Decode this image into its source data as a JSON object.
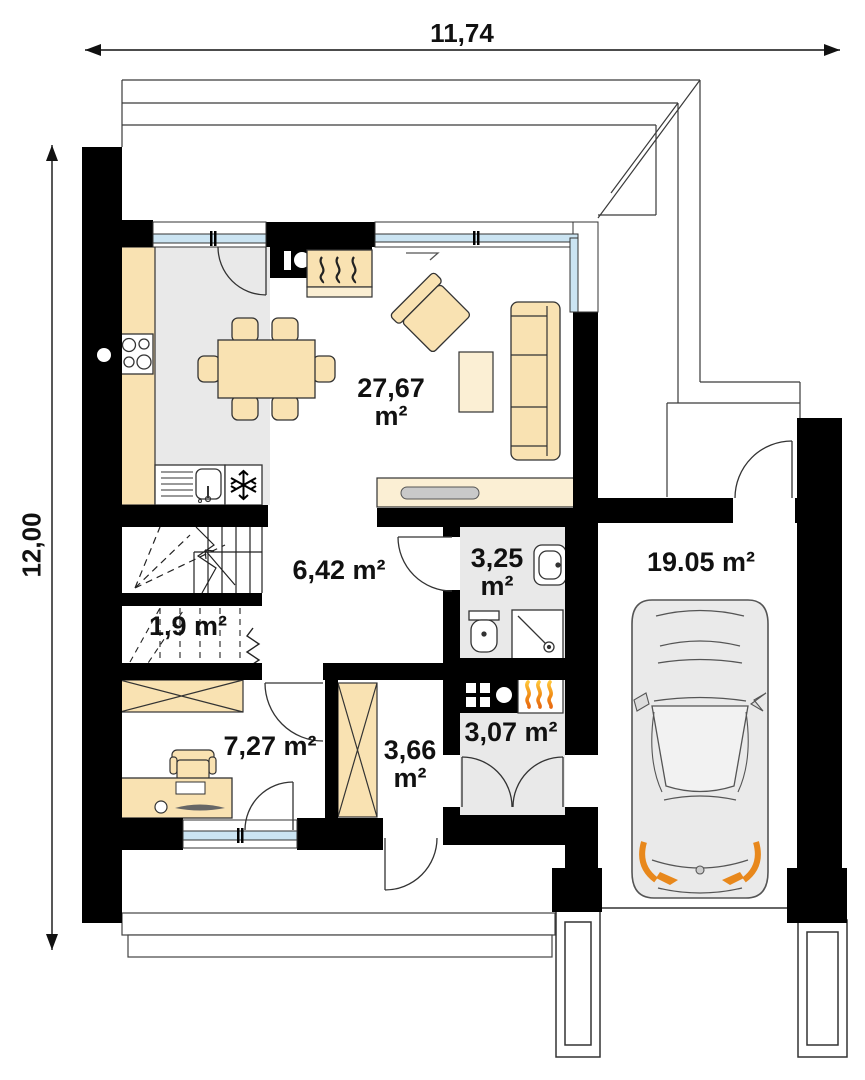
{
  "plan": {
    "type": "floor-plan",
    "floor": "ground-floor"
  },
  "dimensions": {
    "width_total": "11,74",
    "height_total": "12,00"
  },
  "rooms": {
    "living": {
      "lines": [
        "27,67",
        "m²"
      ]
    },
    "hall": {
      "lines": [
        "6,42 m²"
      ]
    },
    "bathroom": {
      "lines": [
        "3,25",
        "m²"
      ]
    },
    "under_stairs": {
      "lines": [
        "1,9 m²"
      ]
    },
    "office": {
      "lines": [
        "7,27 m²"
      ]
    },
    "vestibule": {
      "lines": [
        "3,66",
        "m²"
      ]
    },
    "technical": {
      "lines": [
        "3,07 m²"
      ]
    },
    "garage": {
      "lines": [
        "19.05 m²"
      ]
    }
  },
  "icons": {
    "fridge": "snowflake",
    "cooktop": "four-burner-circles",
    "sink": "basin-with-drainboard",
    "fireplace": "heat-waves",
    "boiler": "flames",
    "washbasin": "oval-basin",
    "toilet": "tank-and-bowl",
    "shower": "square-with-drain",
    "stairs": "treads-with-up-arrow",
    "wardrobe": "crossed-box",
    "car": "car-top-view"
  },
  "colors": {
    "wall": "#000000",
    "furniture": "#F9E2B2",
    "furniture_light": "#FBEFD4",
    "floor_gray": "#E9E9E9",
    "window_glass": "#CBE4F2",
    "flame_orange": "#EE7A17",
    "flame_yellow": "#FFC53A",
    "car_body": "#EAEAEA",
    "car_accent": "#E8881C"
  }
}
